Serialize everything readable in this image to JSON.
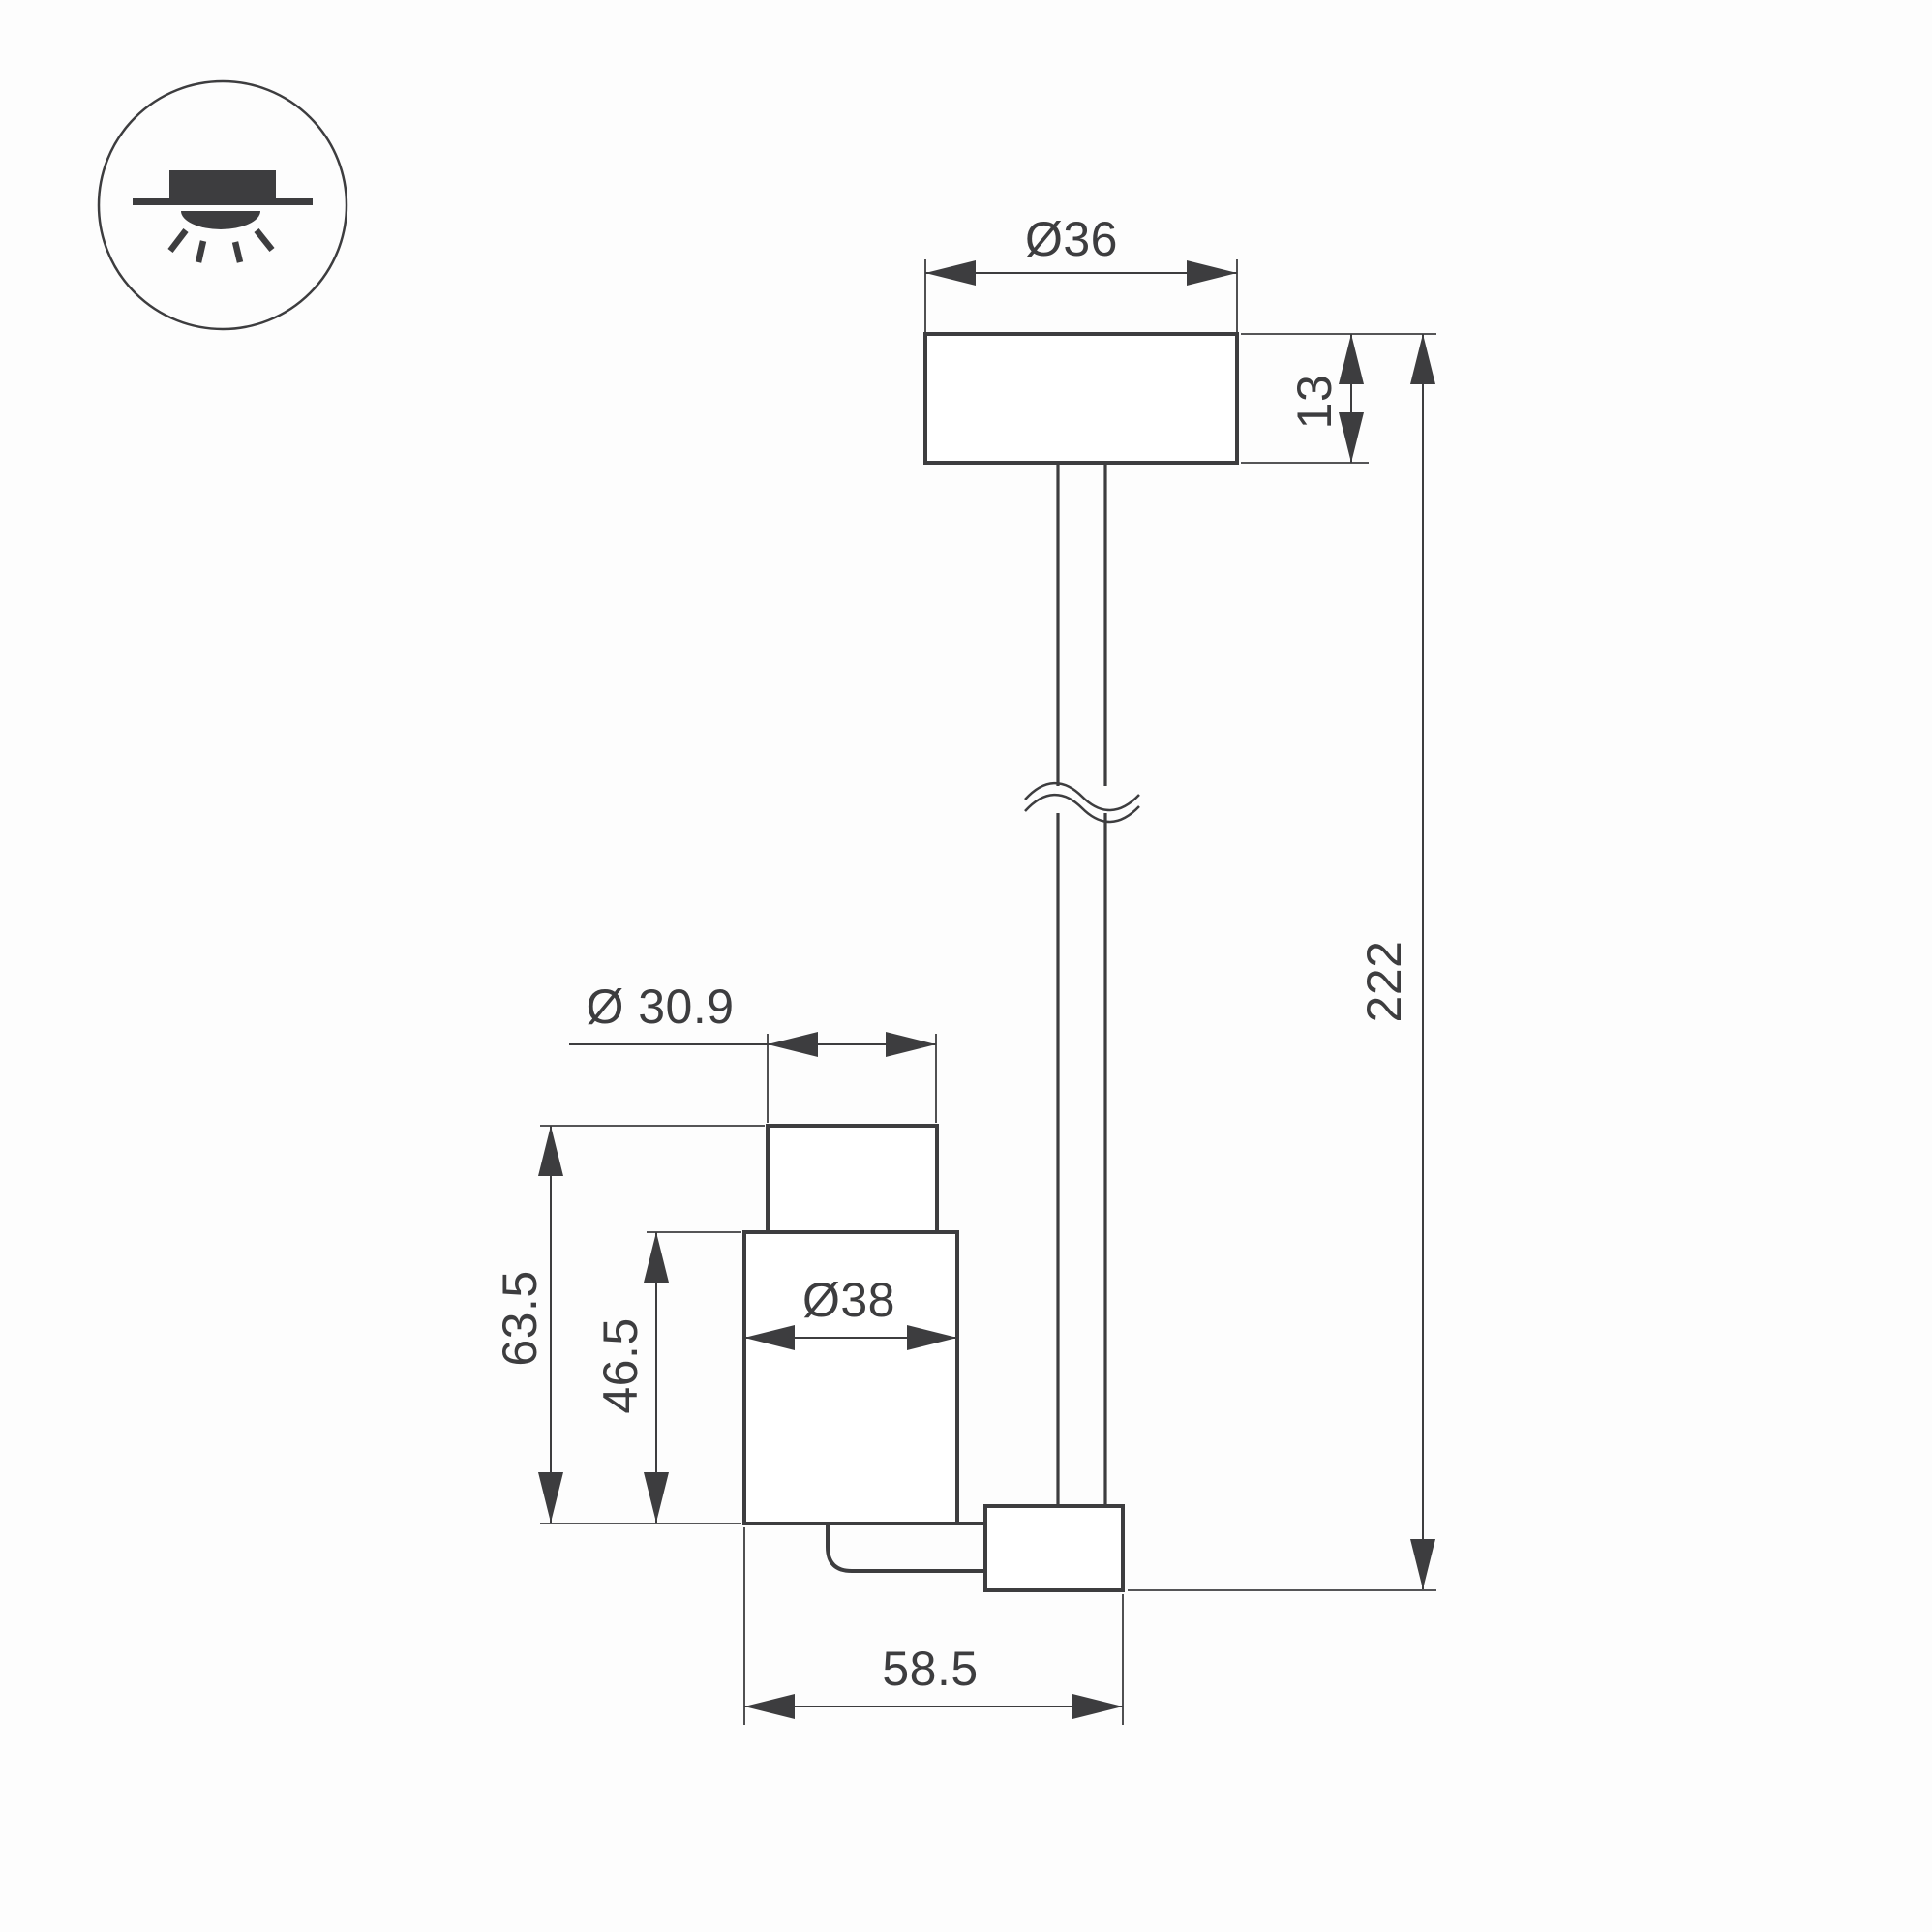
{
  "drawing": {
    "icon": {
      "name": "surface-ceiling-downlight"
    },
    "labels": {
      "canopy_diameter": "Ø36",
      "canopy_height": "13",
      "overall_drop_length": "222",
      "head_front_diameter": "Ø 30.9",
      "head_body_diameter": "Ø38",
      "head_overall_height": "63.5",
      "head_body_height": "46.5",
      "head_overall_width": "58.5"
    },
    "colors": {
      "line": "#3d3d3f",
      "background": "#fdfdfd",
      "shape_fill": "#ffffff"
    }
  }
}
